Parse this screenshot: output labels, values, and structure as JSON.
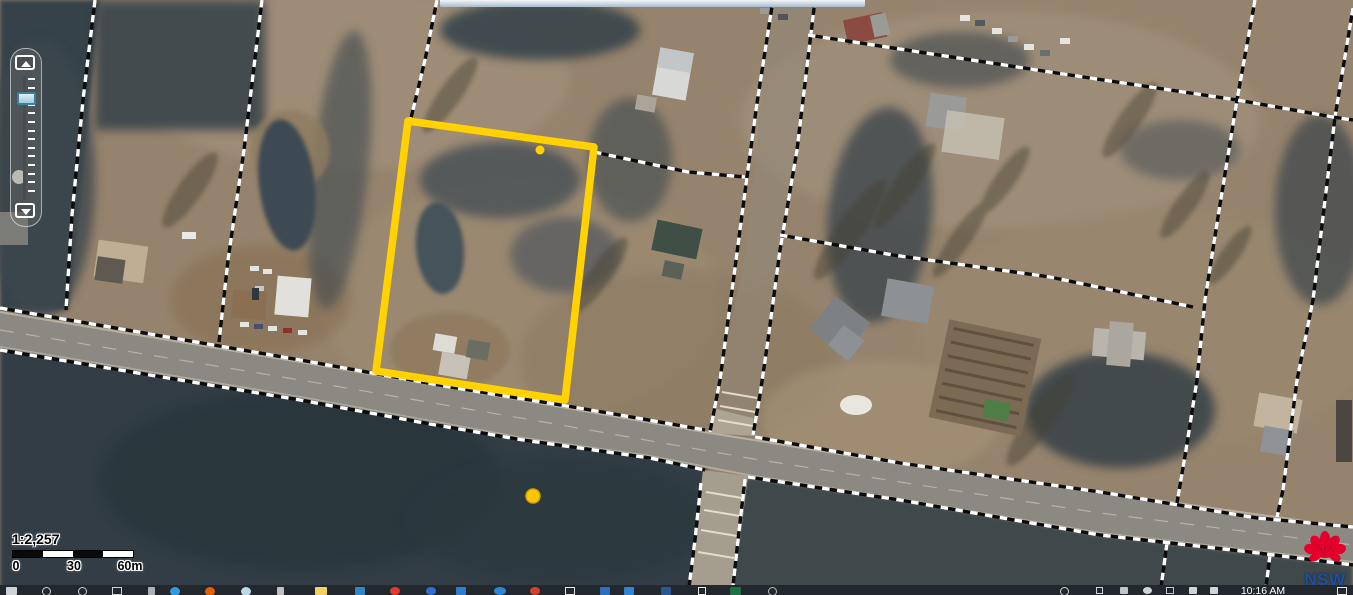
{
  "map": {
    "scale_ratio": "1:2,257",
    "scale_labels": [
      "0",
      "30",
      "60m"
    ],
    "watermark_label": "NSW",
    "features": {
      "selected_parcel": "yellow-outlined cadastral lot",
      "marker_dot": "yellow point marker"
    }
  },
  "zoom_control": {
    "zoom_in_icon": "plus-arrow-up",
    "zoom_out_icon": "arrow-down",
    "handle": "zoom-level-handle"
  },
  "top_bar": {
    "note": "bottom edge of cut-off toolbar"
  },
  "taskbar": {
    "time": "10:16 AM",
    "icons": [
      {
        "name": "start-icon",
        "x": 6,
        "w": 11,
        "h": 8,
        "color": "#cfd3d6",
        "shape": "square"
      },
      {
        "name": "search-icon",
        "x": 42,
        "w": 9,
        "h": 9,
        "color": "#cfd3d6",
        "shape": "ring"
      },
      {
        "name": "cortana-icon",
        "x": 78,
        "w": 9,
        "h": 9,
        "color": "#cfd3d6",
        "shape": "ring"
      },
      {
        "name": "task-view-icon",
        "x": 112,
        "w": 10,
        "h": 8,
        "color": "#cfd3d6",
        "shape": "outline"
      },
      {
        "name": "pen-icon",
        "x": 148,
        "w": 7,
        "h": 8,
        "color": "#aeb2b6",
        "shape": "square"
      },
      {
        "name": "edge-icon",
        "x": 170,
        "w": 10,
        "h": 9,
        "color": "#2f9be3",
        "shape": "circle"
      },
      {
        "name": "firefox-icon",
        "x": 205,
        "w": 10,
        "h": 9,
        "color": "#e66000",
        "shape": "circle"
      },
      {
        "name": "ie-icon",
        "x": 241,
        "w": 10,
        "h": 9,
        "color": "#bdd9e8",
        "shape": "circle"
      },
      {
        "name": "stylus-icon",
        "x": 277,
        "w": 7,
        "h": 8,
        "color": "#c0c0c0",
        "shape": "square"
      },
      {
        "name": "folder-icon",
        "x": 315,
        "w": 12,
        "h": 8,
        "color": "#f7d064",
        "shape": "square"
      },
      {
        "name": "photos-icon",
        "x": 355,
        "w": 10,
        "h": 8,
        "color": "#2f86c9",
        "shape": "square"
      },
      {
        "name": "red-app-icon",
        "x": 390,
        "w": 10,
        "h": 8,
        "color": "#e13b30",
        "shape": "circle"
      },
      {
        "name": "blue-app-icon",
        "x": 426,
        "w": 10,
        "h": 8,
        "color": "#2f6fd6",
        "shape": "circle"
      },
      {
        "name": "blue-tile-icon",
        "x": 456,
        "w": 10,
        "h": 8,
        "color": "#2e7dd1",
        "shape": "square"
      },
      {
        "name": "blue-circles-icon",
        "x": 494,
        "w": 12,
        "h": 8,
        "color": "#2f86d9",
        "shape": "circle"
      },
      {
        "name": "red-white-icon",
        "x": 530,
        "w": 10,
        "h": 8,
        "color": "#d6402f",
        "shape": "circle"
      },
      {
        "name": "window-outline-icon",
        "x": 565,
        "w": 10,
        "h": 8,
        "color": "#e8e8e8",
        "shape": "outline"
      },
      {
        "name": "blue-app2-icon",
        "x": 600,
        "w": 10,
        "h": 8,
        "color": "#2a6fc0",
        "shape": "square"
      },
      {
        "name": "blue-app3-icon",
        "x": 624,
        "w": 10,
        "h": 8,
        "color": "#2f86d9",
        "shape": "square"
      },
      {
        "name": "word-icon",
        "x": 661,
        "w": 10,
        "h": 8,
        "color": "#2b5797",
        "shape": "square"
      },
      {
        "name": "notepad-icon",
        "x": 698,
        "w": 8,
        "h": 8,
        "color": "#e8e8e8",
        "shape": "outline"
      },
      {
        "name": "excel-icon",
        "x": 730,
        "w": 11,
        "h": 8,
        "color": "#1e7145",
        "shape": "square"
      },
      {
        "name": "gray-ring-icon",
        "x": 768,
        "w": 9,
        "h": 9,
        "color": "#b9bcc0",
        "shape": "ring"
      }
    ],
    "tray_icons": [
      {
        "name": "tray-globe-icon",
        "x": 1060,
        "w": 9,
        "h": 9,
        "color": "#d2d5d8",
        "shape": "ring"
      },
      {
        "name": "tray-caret-icon",
        "x": 1096,
        "w": 7,
        "h": 7,
        "color": "#d2d5d8",
        "shape": "outline"
      },
      {
        "name": "tray-icon-1",
        "x": 1120,
        "w": 8,
        "h": 7,
        "color": "#c2c5c8",
        "shape": "square"
      },
      {
        "name": "tray-icon-2",
        "x": 1143,
        "w": 9,
        "h": 7,
        "color": "#d2d5d8",
        "shape": "circle"
      },
      {
        "name": "tray-icon-3",
        "x": 1166,
        "w": 8,
        "h": 7,
        "color": "#c2c5c8",
        "shape": "outline"
      },
      {
        "name": "tray-volume-icon",
        "x": 1189,
        "w": 8,
        "h": 7,
        "color": "#d2d5d8",
        "shape": "square"
      },
      {
        "name": "tray-network-icon",
        "x": 1210,
        "w": 8,
        "h": 7,
        "color": "#d2d5d8",
        "shape": "square"
      }
    ],
    "action_center_icon": "notification-square"
  }
}
